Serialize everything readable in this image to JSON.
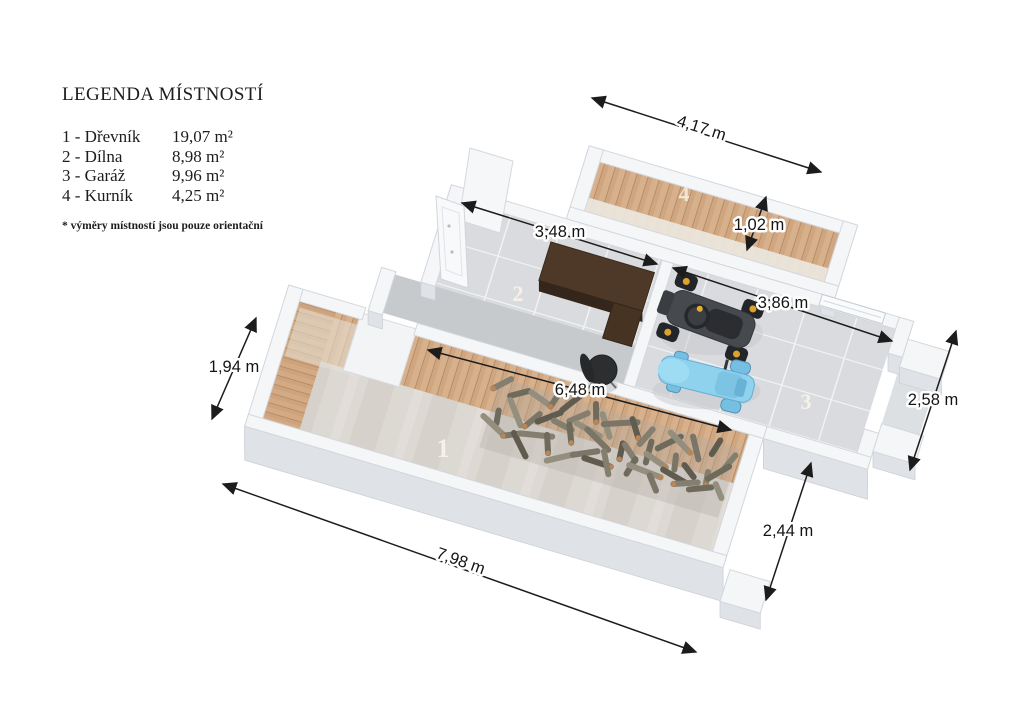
{
  "legend": {
    "title": "LEGENDA MÍSTNOSTÍ",
    "items": [
      {
        "label": "1 - Dřevník",
        "area": "19,07 m²"
      },
      {
        "label": "2 - Dílna",
        "area": "8,98 m²"
      },
      {
        "label": "3 - Garáž",
        "area": "9,96 m²"
      },
      {
        "label": "4 - Kurník",
        "area": "4,25 m²"
      }
    ],
    "note": "* výměry místností jsou pouze orientační"
  },
  "room_labels": {
    "room1": "1",
    "room2": "2",
    "room3": "3",
    "room4": "4"
  },
  "dimensions": {
    "top_width": "4,17 m",
    "coop_depth": "1,02 m",
    "workshop_width": "3,48 m",
    "garage_width": "3,86 m",
    "left_depth": "1,94 m",
    "woodshed_inner": "6,48 m",
    "garage_depth": "2,58 m",
    "woodshed_depth": "2,44 m",
    "woodshed_length": "7,98 m"
  },
  "colors": {
    "wall_top": "#f4f6f8",
    "wall_side": "#dfe3e8",
    "wood_plank": "#d7b08c",
    "tile_floor": "#d9dbde",
    "concrete_floor": "#dcd8d2",
    "tractor_blue": "#8fd2ee",
    "atv_dark": "#46494e",
    "hub_yellow": "#dda22b",
    "dimension_line": "#1c1c1c"
  }
}
